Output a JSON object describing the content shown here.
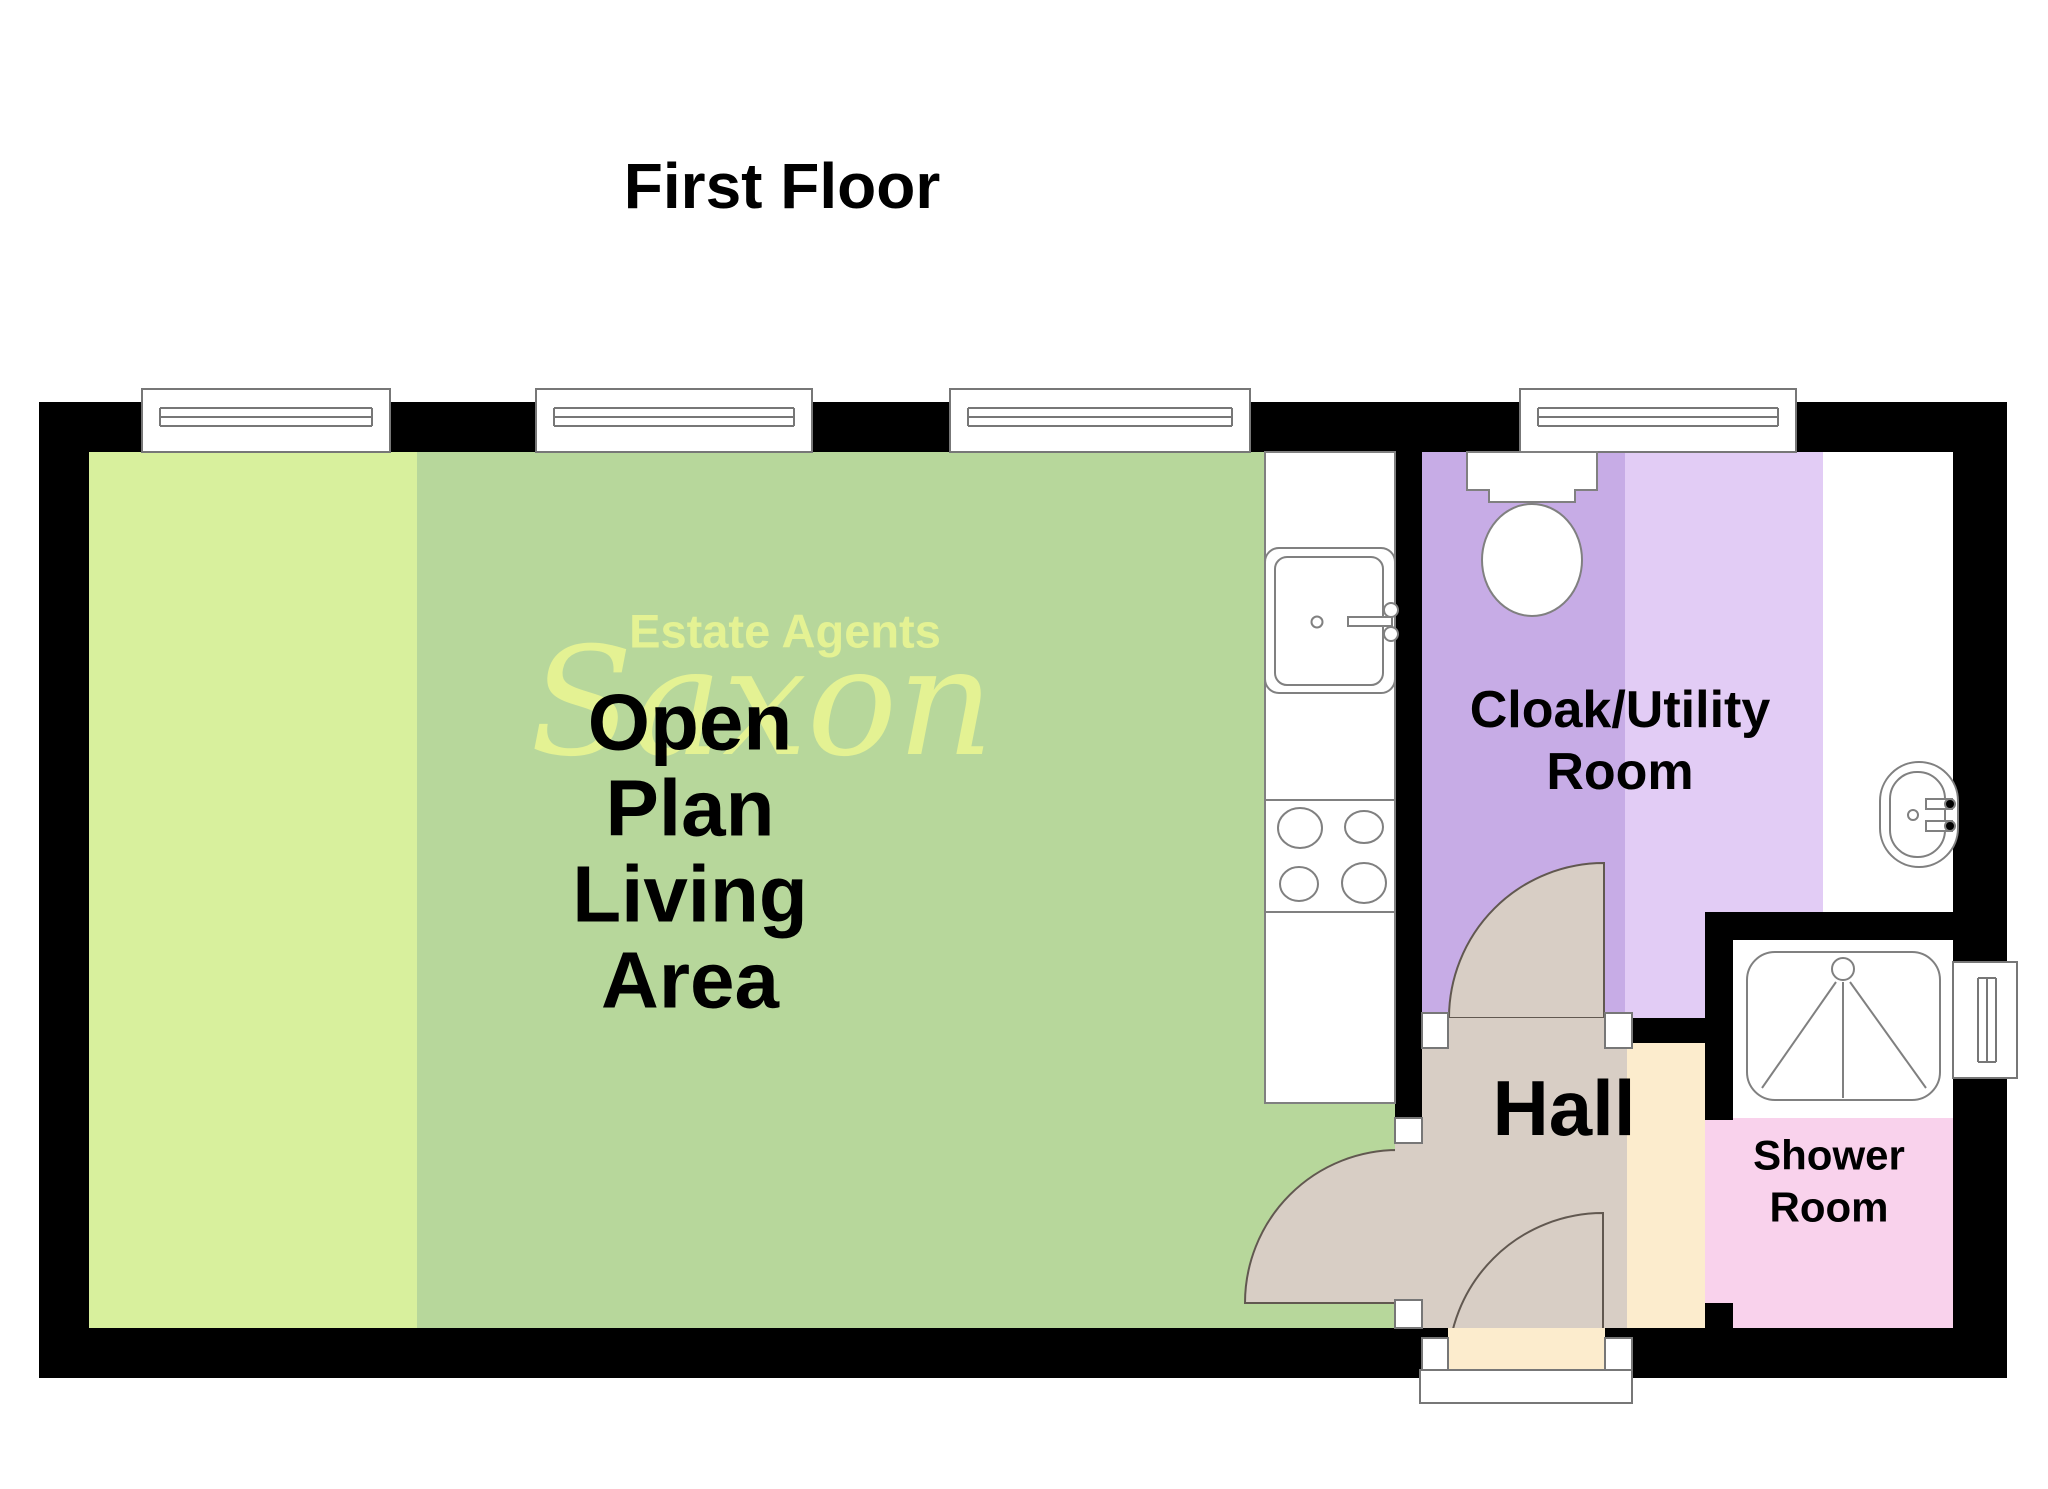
{
  "title": "First Floor",
  "watermark": {
    "brand_prefix": "Estate Agents",
    "brand_name": "Saxon"
  },
  "rooms": {
    "living": {
      "label_lines": [
        "Open",
        "Plan",
        "Living",
        "Area"
      ]
    },
    "cloak": {
      "label_lines": [
        "Cloak/Utility",
        "Room"
      ]
    },
    "hall": {
      "label_lines": [
        "Hall"
      ]
    },
    "shower": {
      "label_lines": [
        "Shower",
        "Room"
      ]
    }
  },
  "colors": {
    "wall": "#000000",
    "living_light": "#d8f09d",
    "living_sage": "#b7d79b",
    "cloak_dark": "#c7ace6",
    "cloak_light": "#e2ccf5",
    "hall_beige": "#fceccd",
    "door_tan": "#d8cec5",
    "shower_pink": "#f9d2ec",
    "utility_white": "#ffffff",
    "watermark": "#e9f593",
    "label_text": "#000000"
  }
}
